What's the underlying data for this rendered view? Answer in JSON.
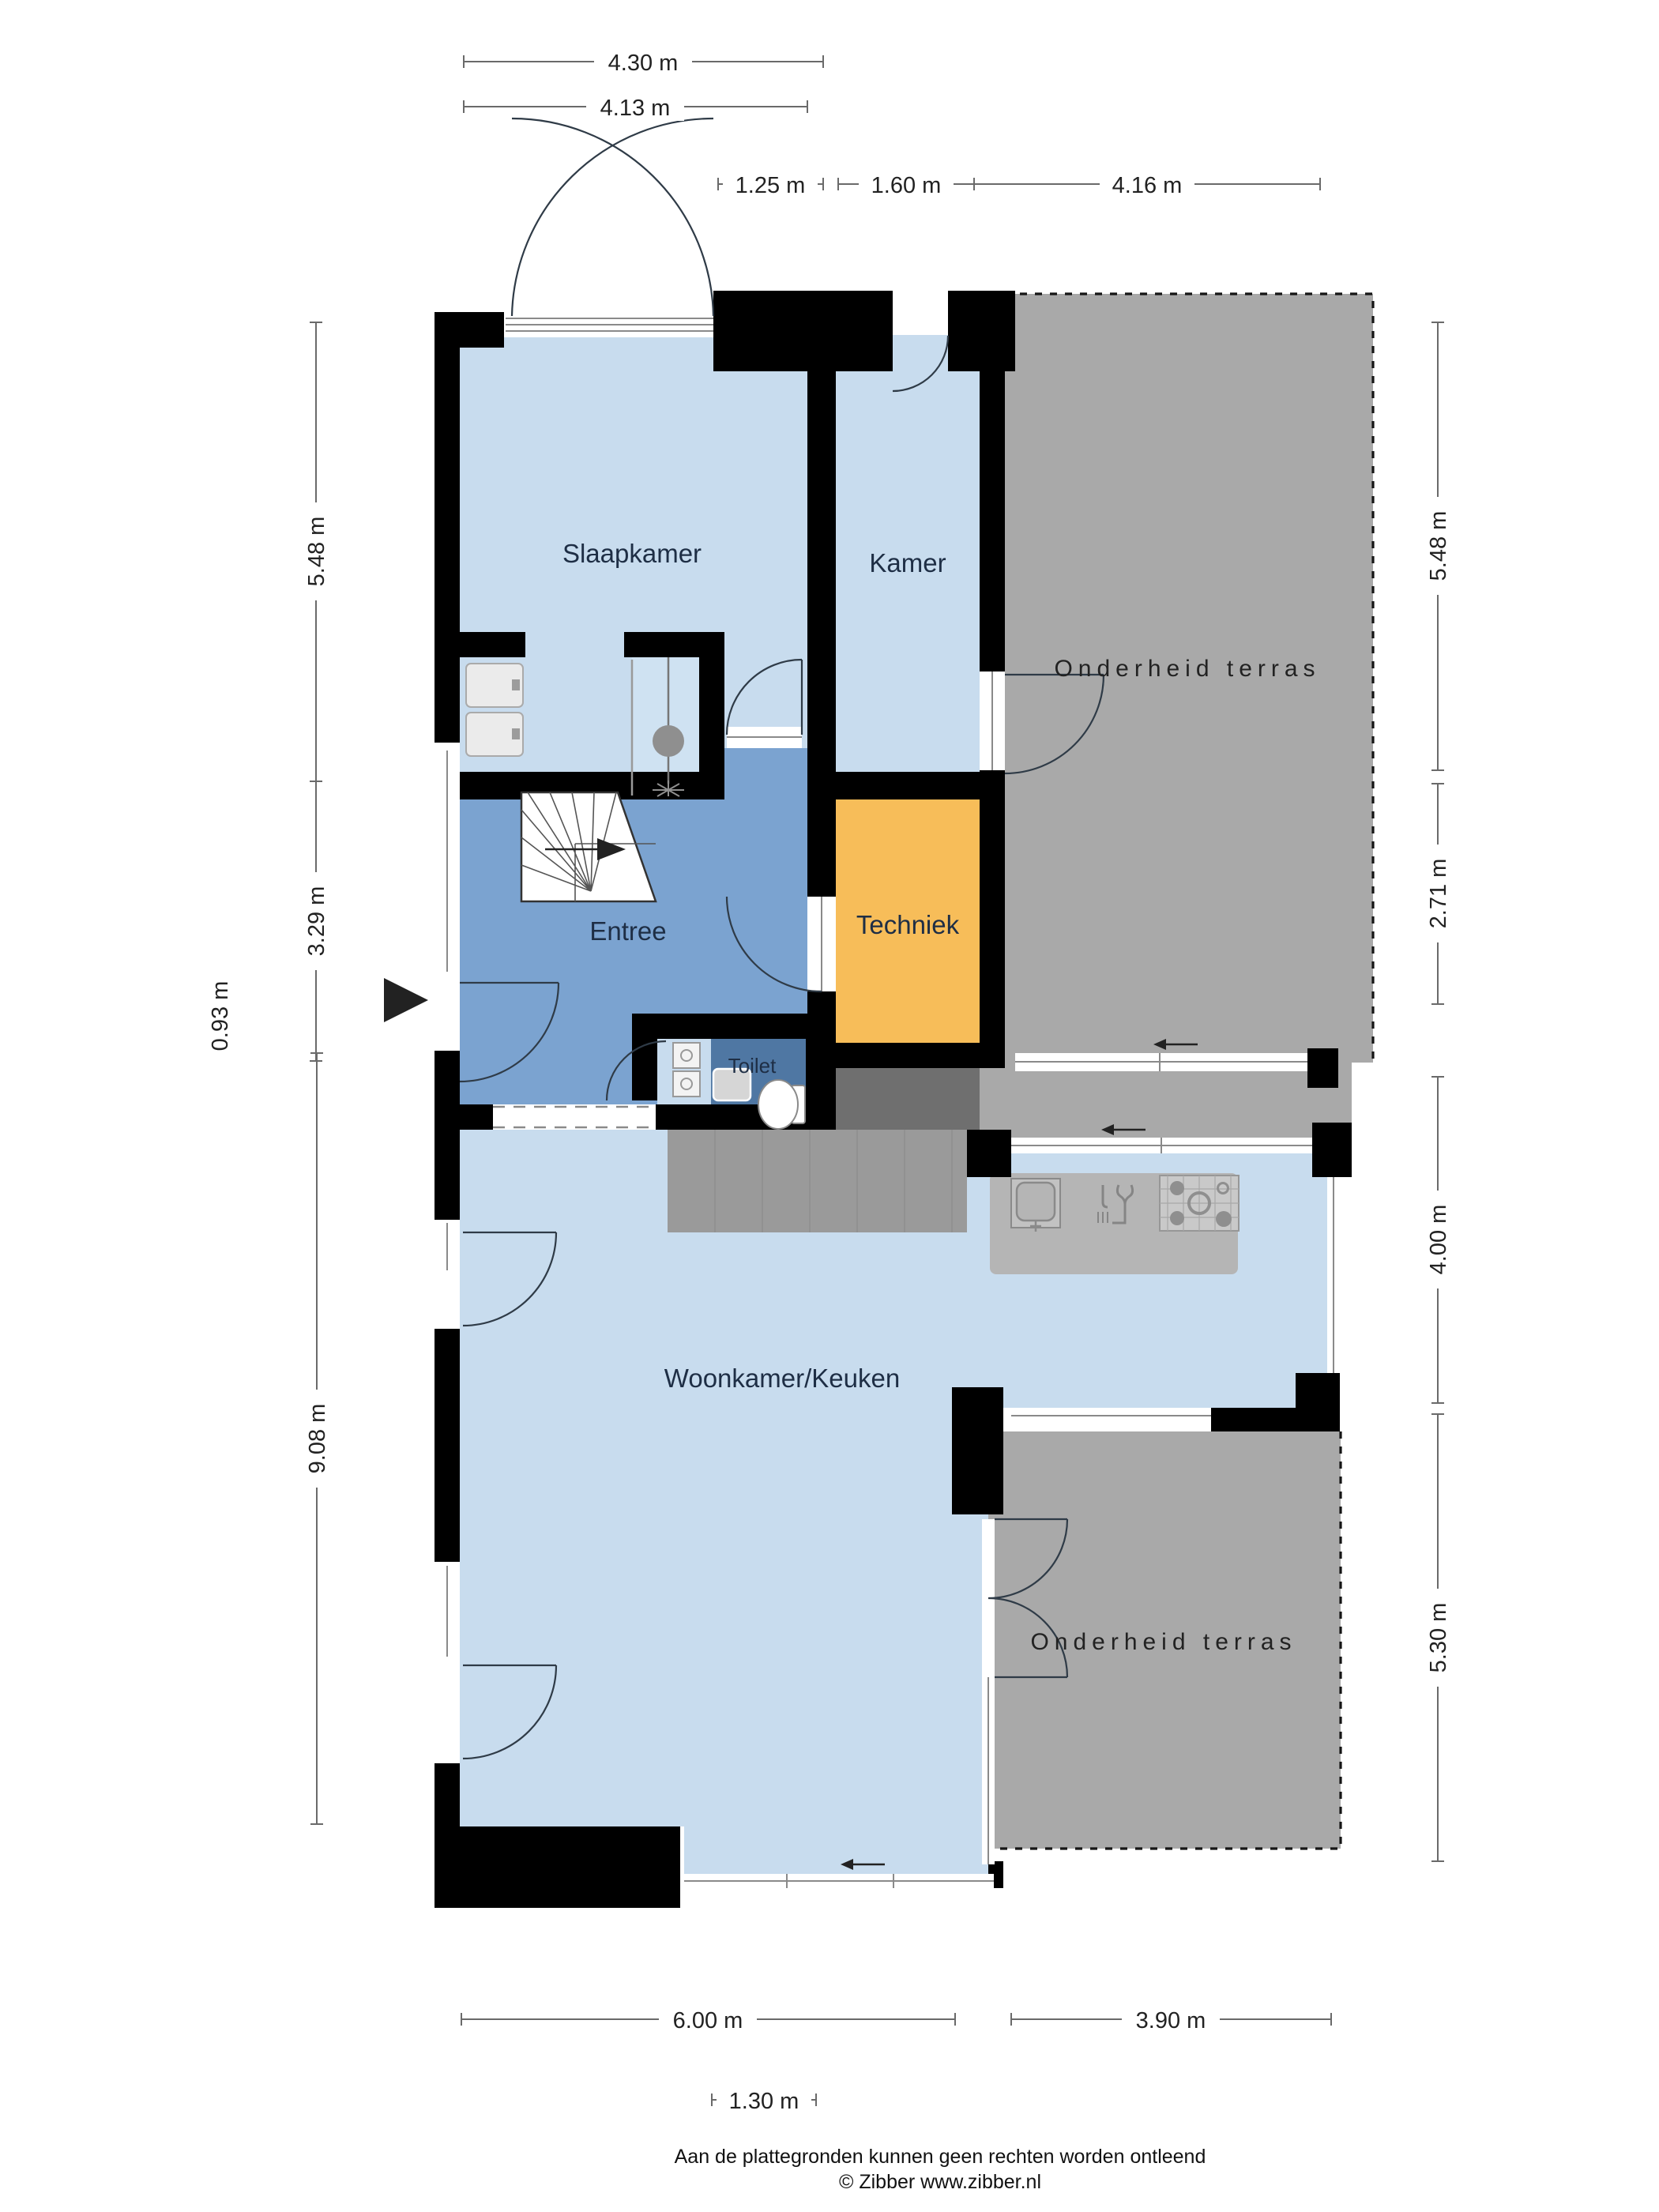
{
  "rooms": {
    "slaapkamer": "Slaapkamer",
    "kamer": "Kamer",
    "terras_boven": "Onderheid terras",
    "entree": "Entree",
    "techniek": "Techniek",
    "toilet": "Toilet",
    "woonkamer": "Woonkamer/Keuken",
    "terras_onder": "Onderheid terras"
  },
  "dims": {
    "t1": "4.30 m",
    "t2": "4.13 m",
    "t3": "1.25 m",
    "t4": "1.60 m",
    "t5": "4.16 m",
    "l1": "5.48 m",
    "l2": "3.29 m",
    "l3": "0.93 m",
    "l4": "9.08 m",
    "r1": "5.48 m",
    "r2": "2.71 m",
    "r3": "4.00 m",
    "r4": "5.30 m",
    "b1": "6.00 m",
    "b2": "3.90 m",
    "b3": "1.30 m"
  },
  "footer": {
    "line1": "Aan de plattegronden kunnen geen rechten worden ontleend",
    "line2": "© Zibber www.zibber.nl"
  },
  "icons": {
    "entrance-arrow-icon": "▶",
    "direction-arrow-icon": "←",
    "stairs-up-arrow-icon": "▶"
  },
  "colors": {
    "wall": "#000000",
    "room_light": "#c8dcee",
    "entree": "#7ba3d0",
    "shower": "#cfe2f2",
    "toilet": "#4f77a3",
    "techniek": "#f7bd59",
    "terrace": "#a9a9a9",
    "step_dark": "#6f6f6f",
    "counter": "#9a9a9a",
    "island": "#b5b5b5"
  }
}
